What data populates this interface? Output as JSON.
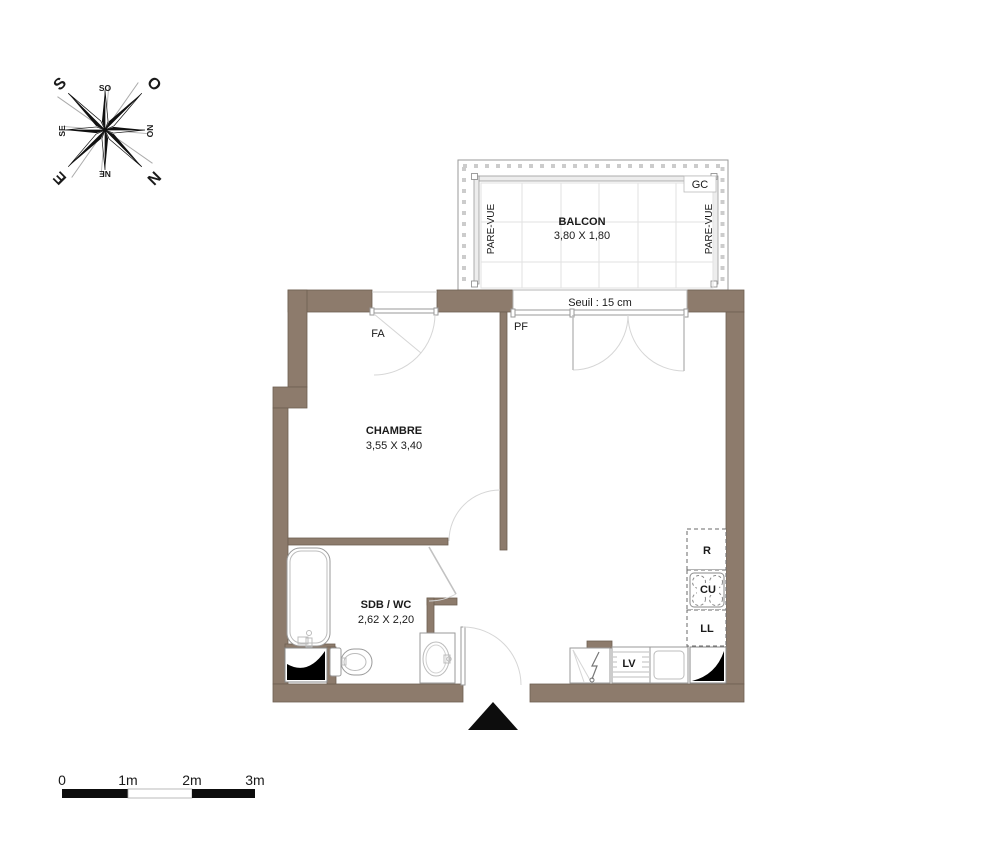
{
  "compass": {
    "n": "N",
    "s": "S",
    "e": "E",
    "o": "O",
    "ne": "NE",
    "no": "NO",
    "se": "SE",
    "so": "SO"
  },
  "balcony": {
    "name": "BALCON",
    "dims": "3,80 X 1,80",
    "gc_label": "GC",
    "pare_vue_left": "PARE-VUE",
    "pare_vue_right": "PARE-VUE"
  },
  "threshold": {
    "label": "Seuil : 15 cm"
  },
  "rooms": {
    "chambre": {
      "name": "CHAMBRE",
      "dims": "3,55 X 3,40"
    },
    "sdb_wc": {
      "name": "SDB / WC",
      "dims": "2,62 X 2,20"
    }
  },
  "openings": {
    "window_label": "FA",
    "french_door_label": "PF"
  },
  "kitchen": {
    "fridge": "R",
    "hob": "CU",
    "washing_machine": "LL",
    "dishwasher": "LV"
  },
  "scale_bar": {
    "labels": [
      "0",
      "1m",
      "2m",
      "3m"
    ]
  },
  "colors": {
    "wall": "#8d7b6c",
    "wall_edge": "#6e5f52",
    "black": "#111111"
  }
}
